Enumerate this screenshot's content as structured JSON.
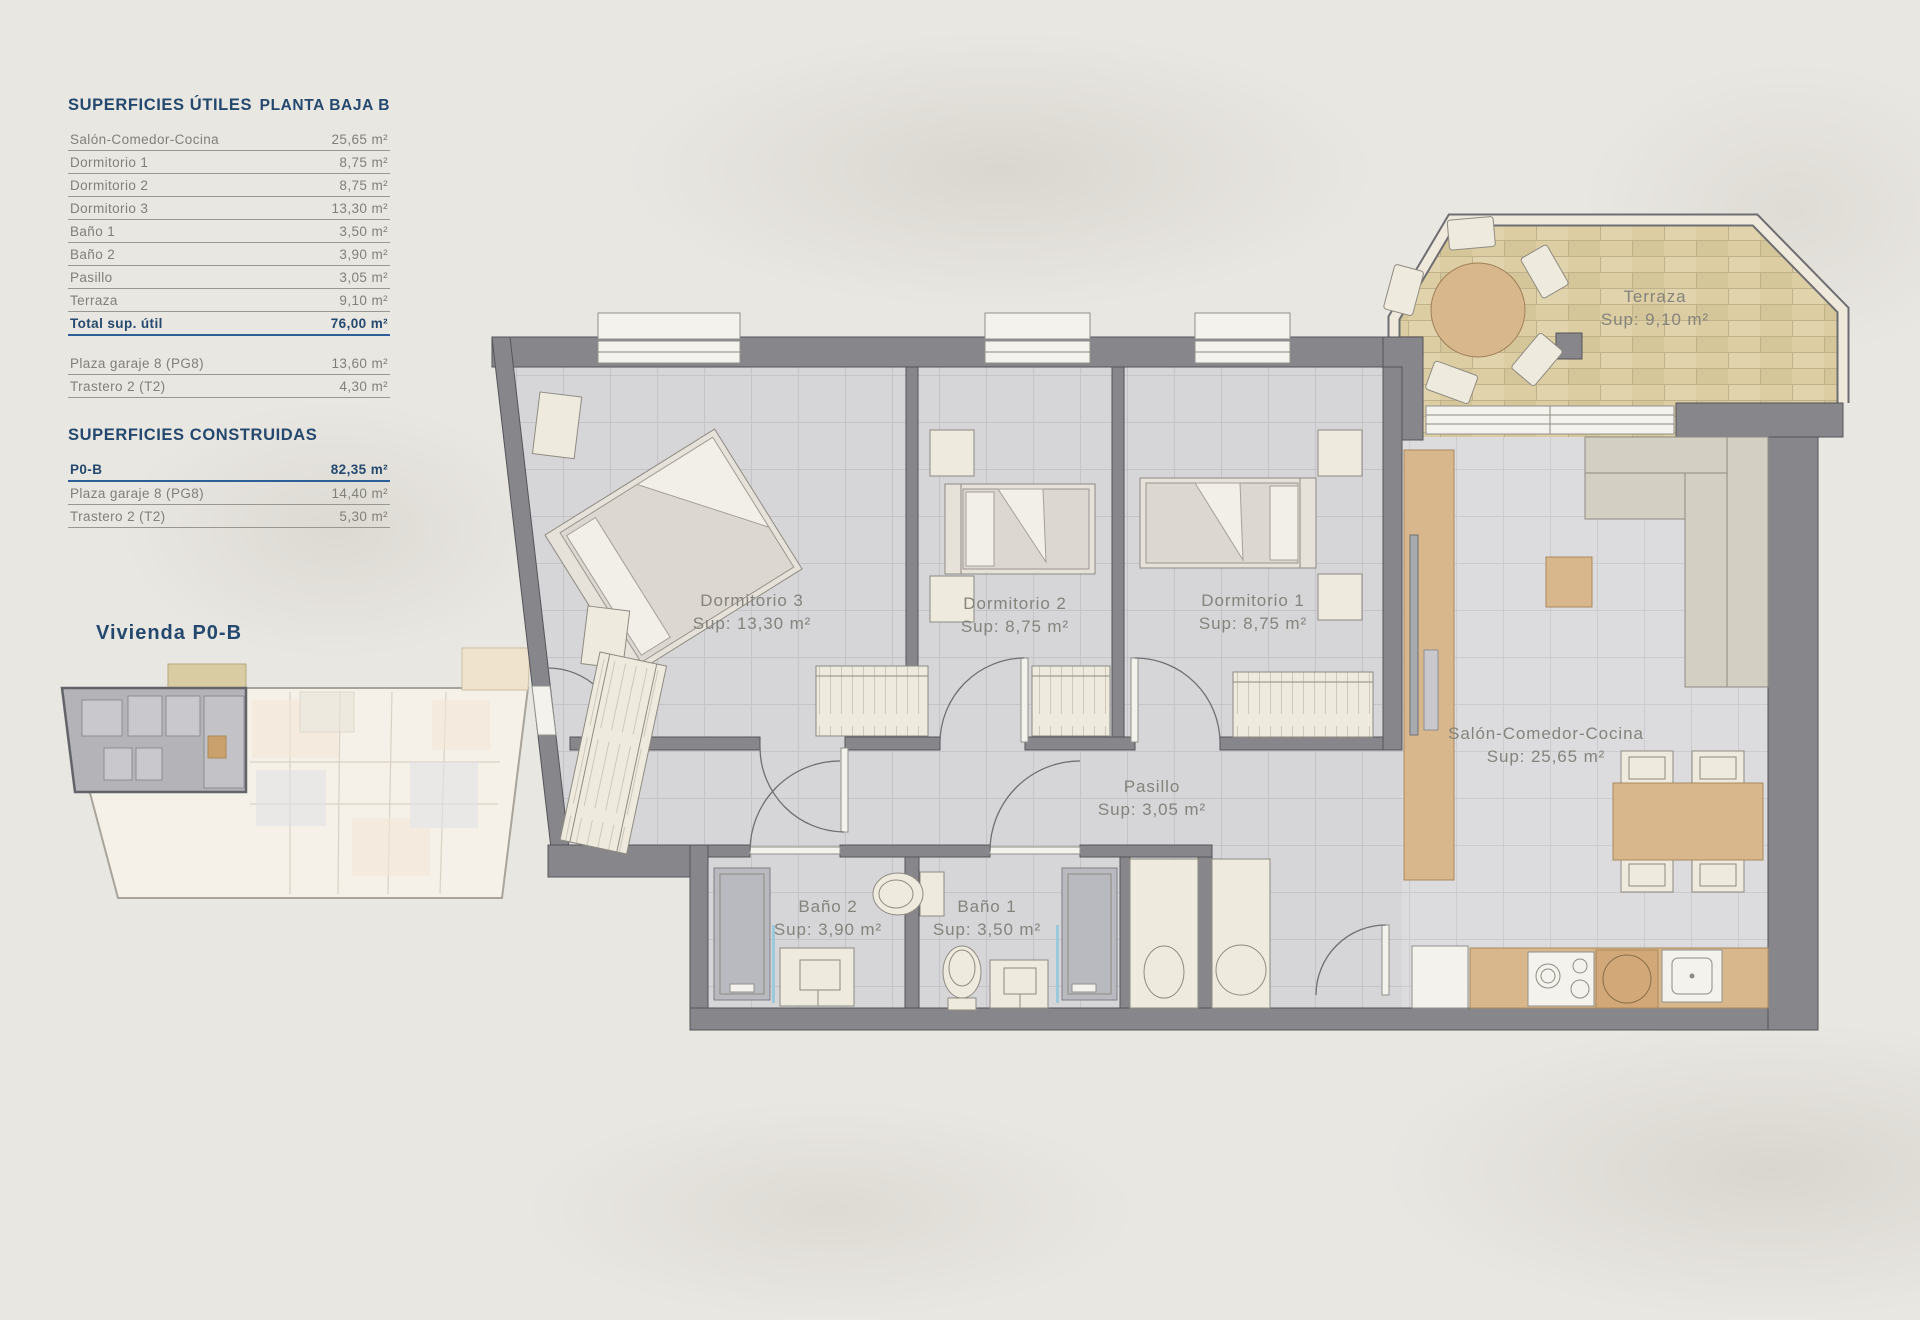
{
  "colors": {
    "background": "#e9e7e2",
    "accent_blue": "#24486e",
    "table_text_gray": "#807f78",
    "wall_gray": "#87878b",
    "floor_tile_gray": "#d6d6d9",
    "terrace_tan": "#dccda3",
    "wood": "#d9b78c"
  },
  "sidebar": {
    "utiles": {
      "title": "SUPERFICIES ÚTILES",
      "floor": "PLANTA BAJA B",
      "rows": [
        {
          "label": "Salón-Comedor-Cocina",
          "value": "25,65 m²"
        },
        {
          "label": "Dormitorio 1",
          "value": "8,75 m²"
        },
        {
          "label": "Dormitorio 2",
          "value": "8,75 m²"
        },
        {
          "label": "Dormitorio 3",
          "value": "13,30 m²"
        },
        {
          "label": "Baño 1",
          "value": "3,50 m²"
        },
        {
          "label": "Baño 2",
          "value": "3,90 m²"
        },
        {
          "label": "Pasillo",
          "value": "3,05 m²"
        },
        {
          "label": "Terraza",
          "value": "9,10 m²"
        }
      ],
      "total": {
        "label": "Total sup. útil",
        "value": "76,00 m²"
      },
      "annex_rows": [
        {
          "label": "Plaza garaje 8 (PG8)",
          "value": "13,60 m²"
        },
        {
          "label": "Trastero 2 (T2)",
          "value": "4,30 m²"
        }
      ]
    },
    "construidas": {
      "title": "SUPERFICIES CONSTRUIDAS",
      "total": {
        "label": "P0-B",
        "value": "82,35 m²"
      },
      "rows": [
        {
          "label": "Plaza garaje 8 (PG8)",
          "value": "14,40 m²"
        },
        {
          "label": "Trastero 2 (T2)",
          "value": "5,30 m²"
        }
      ]
    },
    "overview_label": "Vivienda P0-B"
  },
  "plan": {
    "rooms": [
      {
        "id": "dormitorio3",
        "name": "Dormitorio 3",
        "sup": "Sup: 13,30 m²"
      },
      {
        "id": "dormitorio2",
        "name": "Dormitorio 2",
        "sup": "Sup: 8,75 m²"
      },
      {
        "id": "dormitorio1",
        "name": "Dormitorio 1",
        "sup": "Sup: 8,75 m²"
      },
      {
        "id": "pasillo",
        "name": "Pasillo",
        "sup": "Sup: 3,05 m²"
      },
      {
        "id": "bano2",
        "name": "Baño 2",
        "sup": "Sup: 3,90 m²"
      },
      {
        "id": "bano1",
        "name": "Baño 1",
        "sup": "Sup: 3,50 m²"
      },
      {
        "id": "salon",
        "name": "Salón-Comedor-Cocina",
        "sup": "Sup: 25,65 m²"
      },
      {
        "id": "terraza",
        "name": "Terraza",
        "sup": "Sup: 9,10 m²"
      }
    ]
  }
}
